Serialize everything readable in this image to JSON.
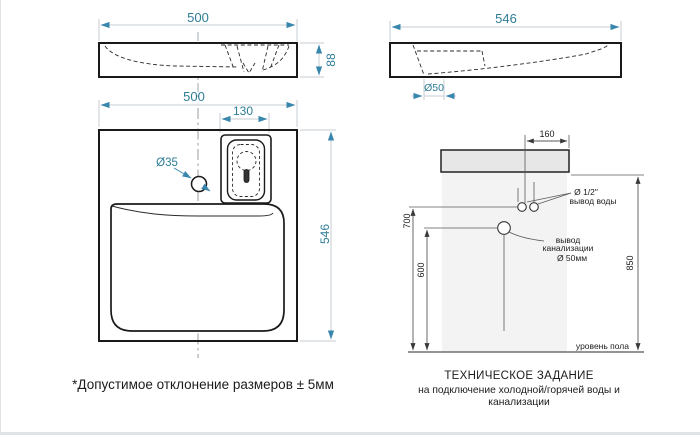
{
  "colors": {
    "dimension_accent": "#2e7d96",
    "arrow_accent": "#3a87ad",
    "dim_line": "#c6ccd1",
    "drawing_line": "#1a1a1a",
    "install_line": "#4a4a4a",
    "sink_fill": "#e7e7e7",
    "wall_fill": "#f3f3f3"
  },
  "views": {
    "front_elevation": {
      "width_label": "500",
      "height_label": "88"
    },
    "side_elevation": {
      "width_label": "546",
      "drain_label": "Ø50"
    },
    "top_view": {
      "width_label": "500",
      "drain_width_label": "130",
      "faucet_hole_label": "Ø35",
      "depth_label": "546"
    },
    "installation": {
      "offset_label": "160",
      "water_height_label": "700",
      "drain_height_label": "600",
      "overall_height_label": "850",
      "water_note_line1": "Ø 1/2\"",
      "water_note_line2": "вывод воды",
      "drain_note_line1": "вывод",
      "drain_note_line2": "канализации",
      "drain_note_line3": "Ø 50мм",
      "floor_label": "уровень пола"
    }
  },
  "captions": {
    "tolerance_note": "*Допустимое отклонение размеров ± 5мм",
    "spec_title": "ТЕХНИЧЕСКОЕ ЗАДАНИЕ",
    "spec_subtitle": "на подключение холодной/горячей воды и канализации"
  }
}
